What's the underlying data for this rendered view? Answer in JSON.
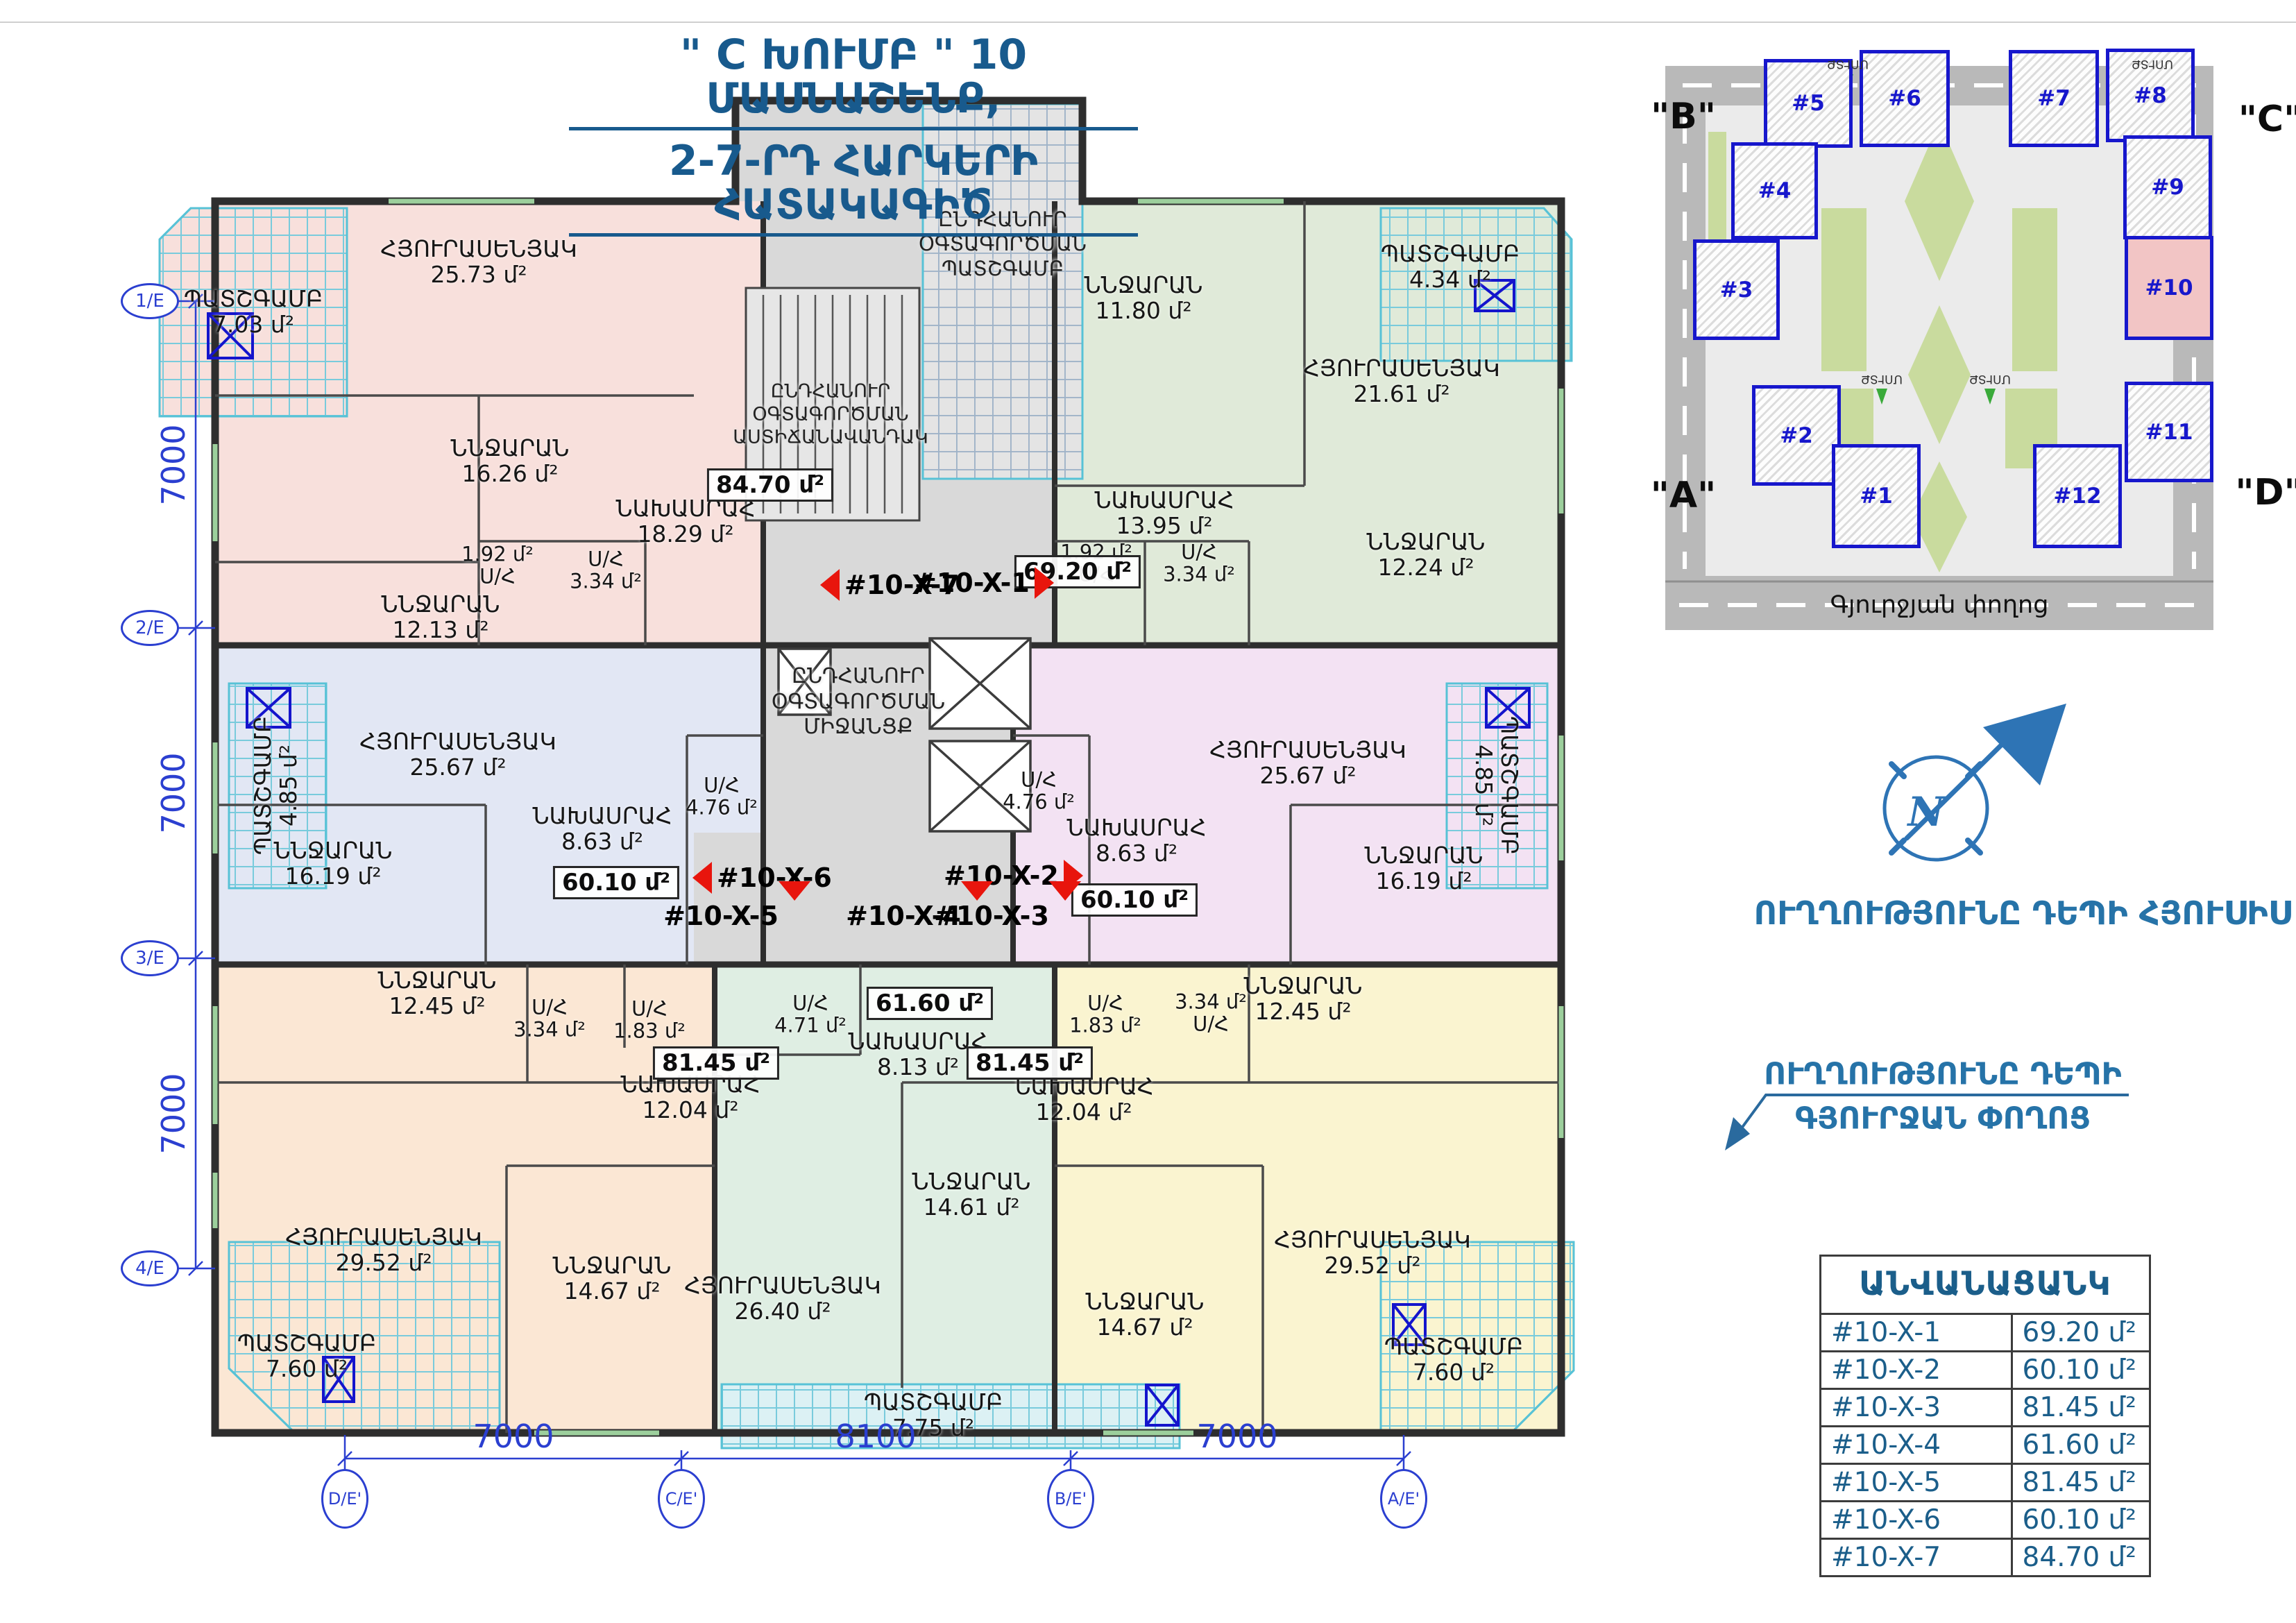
{
  "title": {
    "line1": "\" C ԽՈՒՄԲ \" 10 ՄԱՍՆԱՇԵՆՔ,",
    "line2": "2-7-ՐԴ  ՀԱՐԿԵՐԻ  ՀԱՏԱԿԱԳԻԾ"
  },
  "axes": {
    "left": [
      "1/E",
      "2/E",
      "3/E",
      "4/E"
    ],
    "left_dims": [
      "7000",
      "7000",
      "7000"
    ],
    "bottom": [
      "D/E'",
      "C/E'",
      "B/E'",
      "A/E'"
    ],
    "bottom_dims": [
      "7000",
      "8100",
      "7000"
    ]
  },
  "plan": {
    "common": {
      "balcony": "ԸՆԴՀԱՆՈՒՐ\nՕԳՏԱԳՈՐԾՄԱՆ\nՊԱՏՇԳԱՄԲ",
      "stairs": "ԸՆԴՀԱՆՈՒՐ\nՕԳՏԱԳՈՐԾՄԱՆ\nԱՍՏԻՃԱՆԱՎԱՆԴԱԿ",
      "corridor": "ԸՆԴՀԱՆՈՒՐ\nՕԳՏԱԳՈՐԾՄԱՆ\nՄԻՋԱՆՑՔ"
    },
    "markers": {
      "x1": "#10-X-1",
      "x2": "#10-X-2",
      "x3": "#10-X-3",
      "x4": "#10-X-4",
      "x5": "#10-X-5",
      "x6": "#10-X-6",
      "x7": "#10-X-7"
    },
    "apartments": [
      {
        "id": "#10-X-7",
        "total": "84.70 մ²",
        "rooms": [
          {
            "name": "ՊԱՏՇԳԱՄԲ",
            "area": "7.03 մ²"
          },
          {
            "name": "ՀՅՈՒՐԱՍԵՆՅԱԿ",
            "area": "25.73 մ²"
          },
          {
            "name": "ՆՆՋԱՐԱՆ",
            "area": "16.26 մ²"
          },
          {
            "name": "ՆՆՋԱՐԱՆ",
            "area": "12.13 մ²"
          },
          {
            "name": "ՆԱԽԱՍՐԱՀ",
            "area": "18.29 մ²"
          },
          {
            "name": "Ս/Հ",
            "area": "1.92 մ²"
          },
          {
            "name": "Ս/Հ",
            "area": "3.34 մ²"
          }
        ]
      },
      {
        "id": "#10-X-1",
        "total": "69.20 մ²",
        "rooms": [
          {
            "name": "ՊԱՏՇԳԱՄԲ",
            "area": "4.34 մ²"
          },
          {
            "name": "ՆՆՋԱՐԱՆ",
            "area": "11.80 մ²"
          },
          {
            "name": "ՀՅՈՒՐԱՍԵՆՅԱԿ",
            "area": "21.61 մ²"
          },
          {
            "name": "ՆԱԽԱՍՐԱՀ",
            "area": "13.95 մ²"
          },
          {
            "name": "Ս/Հ",
            "area": "1.92 մ²"
          },
          {
            "name": "Ս/Հ",
            "area": "3.34 մ²"
          },
          {
            "name": "ՆՆՋԱՐԱՆ",
            "area": "12.24 մ²"
          }
        ]
      },
      {
        "id": "#10-X-6",
        "total": "60.10 մ²",
        "rooms": [
          {
            "name": "ՊԱՏՇԳԱՄԲ",
            "area": "4.85 մ²"
          },
          {
            "name": "ՀՅՈՒՐԱՍԵՆՅԱԿ",
            "area": "25.67 մ²"
          },
          {
            "name": "ՆՆՋԱՐԱՆ",
            "area": "16.19 մ²"
          },
          {
            "name": "ՆԱԽԱՍՐԱՀ",
            "area": "8.63 մ²"
          },
          {
            "name": "Ս/Հ",
            "area": "4.76 մ²"
          }
        ]
      },
      {
        "id": "#10-X-2",
        "total": "60.10 մ²",
        "rooms": [
          {
            "name": "ՀՅՈՒՐԱՍԵՆՅԱԿ",
            "area": "25.67 մ²"
          },
          {
            "name": "ՊԱՏՇԳԱՄԲ",
            "area": "4.85 մ²"
          },
          {
            "name": "Ս/Հ",
            "area": "4.76 մ²"
          },
          {
            "name": "ՆԱԽԱՍՐԱՀ",
            "area": "8.63 մ²"
          },
          {
            "name": "ՆՆՋԱՐԱՆ",
            "area": "16.19 մ²"
          }
        ]
      },
      {
        "id": "#10-X-5",
        "total": "81.45 մ²",
        "rooms": [
          {
            "name": "ՆՆՋԱՐԱՆ",
            "area": "12.45 մ²"
          },
          {
            "name": "Ս/Հ",
            "area": "3.34 մ²"
          },
          {
            "name": "Ս/Հ",
            "area": "1.83 մ²"
          },
          {
            "name": "ՆԱԽԱՍՐԱՀ",
            "area": "12.04 մ²"
          },
          {
            "name": "ՀՅՈՒՐԱՍԵՆՅԱԿ",
            "area": "29.52 մ²"
          },
          {
            "name": "ՆՆՋԱՐԱՆ",
            "area": "14.67 մ²"
          },
          {
            "name": "ՊԱՏՇԳԱՄԲ",
            "area": "7.60 մ²"
          }
        ]
      },
      {
        "id": "#10-X-4",
        "total": "61.60 մ²",
        "rooms": [
          {
            "name": "Ս/Հ",
            "area": "4.71 մ²"
          },
          {
            "name": "ՆԱԽԱՍՐԱՀ",
            "area": "8.13 մ²"
          },
          {
            "name": "ՆՆՋԱՐԱՆ",
            "area": "14.61 մ²"
          },
          {
            "name": "ՀՅՈՒՐԱՍԵՆՅԱԿ",
            "area": "26.40 մ²"
          },
          {
            "name": "ՊԱՏՇԳԱՄԲ",
            "area": "7.75 մ²"
          }
        ]
      },
      {
        "id": "#10-X-3",
        "total": "81.45 մ²",
        "rooms": [
          {
            "name": "Ս/Հ",
            "area": "1.83 մ²"
          },
          {
            "name": "Ս/Հ",
            "area": "3.34 մ²"
          },
          {
            "name": "ՆԱԽԱՍՐԱՀ",
            "area": "12.04 մ²"
          },
          {
            "name": "ՆՆՋԱՐԱՆ",
            "area": "12.45 մ²"
          },
          {
            "name": "ՆՆՋԱՐԱՆ",
            "area": "14.67 մ²"
          },
          {
            "name": "ՀՅՈՒՐԱՍԵՆՅԱԿ",
            "area": "29.52 մ²"
          },
          {
            "name": "ՊԱՏՇԳԱՄԲ",
            "area": "7.60 մ²"
          }
        ]
      }
    ]
  },
  "site_plan": {
    "labels": {
      "b": "\"B\"",
      "c": "\"C\"",
      "a": "\"A\"",
      "d": "\"D\""
    },
    "street": "Գյուրջյան փողոց",
    "entrance": "ՄՈՒՏՔ",
    "buildings": [
      "#1",
      "#2",
      "#3",
      "#4",
      "#5",
      "#6",
      "#7",
      "#8",
      "#9",
      "#10",
      "#11",
      "#12"
    ]
  },
  "compass": {
    "letter": "N",
    "note": "ՈՒՂՂՈՒԹՅՈՒՆԸ ԴԵՊԻ ՀՅՈՒՍԻՍ"
  },
  "direction_note": {
    "line1": "ՈՒՂՂՈՒԹՅՈՒՆԸ ԴԵՊԻ",
    "line2": "ԳՅՈՒՐՋԱՆ ՓՈՂՈՑ"
  },
  "legend_table": {
    "title": "ԱՆՎԱՆԱՑԱՆԿ",
    "rows": [
      {
        "id": "#10-X-1",
        "area": "69.20 մ²"
      },
      {
        "id": "#10-X-2",
        "area": "60.10 մ²"
      },
      {
        "id": "#10-X-3",
        "area": "81.45 մ²"
      },
      {
        "id": "#10-X-4",
        "area": "61.60 մ²"
      },
      {
        "id": "#10-X-5",
        "area": "81.45 մ²"
      },
      {
        "id": "#10-X-6",
        "area": "60.10 մ²"
      },
      {
        "id": "#10-X-7",
        "area": "84.70 մ²"
      }
    ]
  },
  "colors": {
    "title_blue": "#185a8d",
    "axis_blue": "#2b3fd0",
    "marker_red": "#e8150d",
    "building_outline": "#1717cc",
    "highlight_pink": "#f2c5c5"
  }
}
